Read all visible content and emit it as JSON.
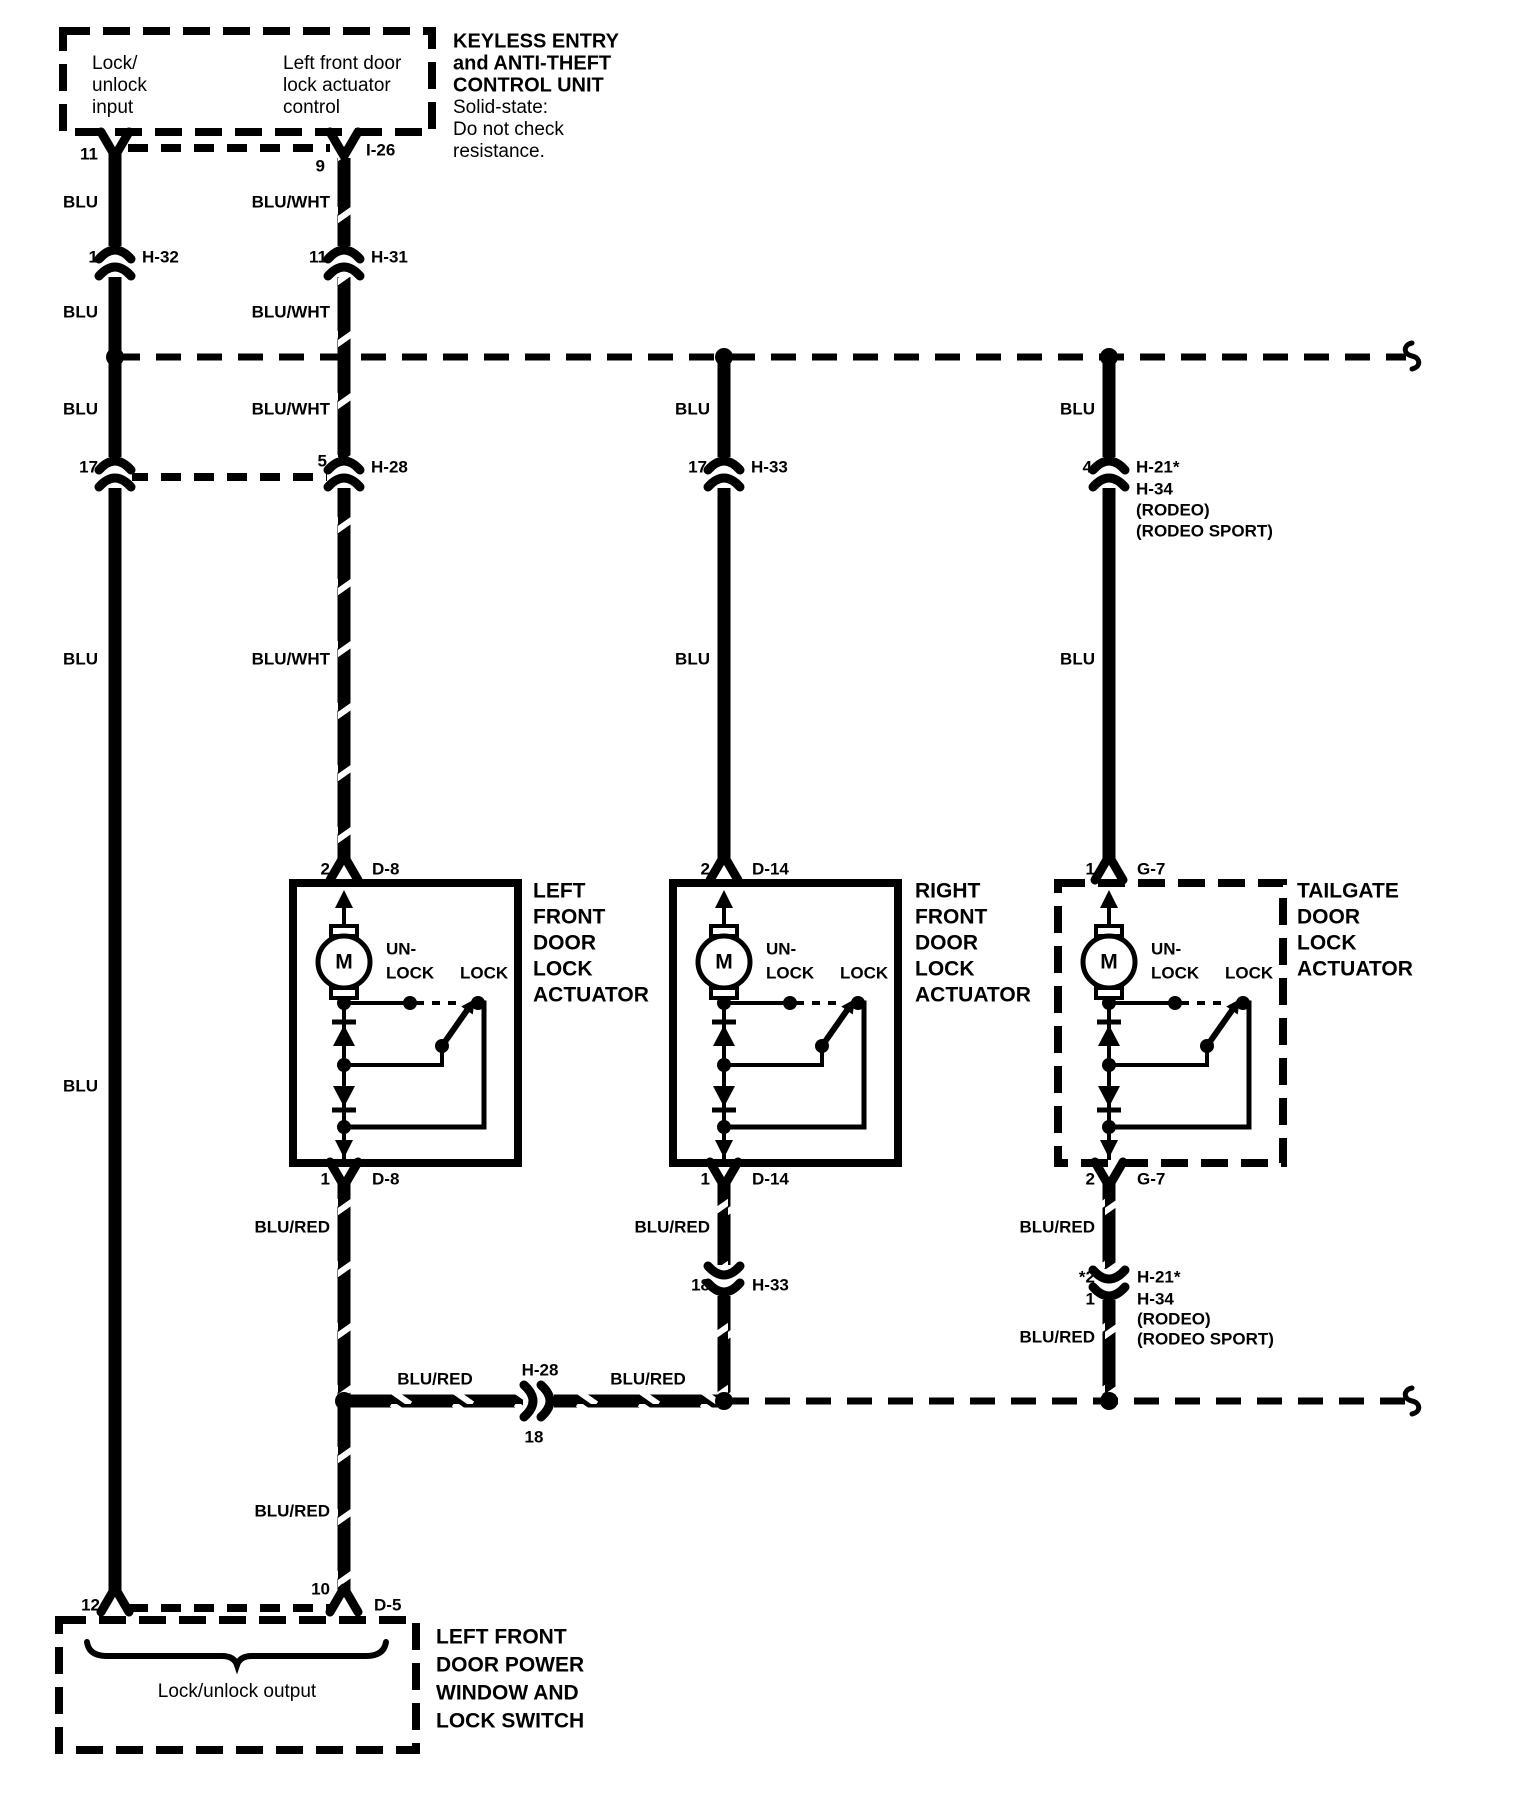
{
  "control_unit": {
    "title_lines": [
      "KEYLESS ENTRY",
      "and ANTI-THEFT",
      "CONTROL UNIT"
    ],
    "note_lines": [
      "Solid-state:",
      "Do not check",
      "resistance."
    ],
    "input_lines": [
      "Lock/",
      "unlock",
      "input"
    ],
    "output_lines": [
      "Left front door",
      "lock actuator",
      "control"
    ]
  },
  "switch_unit": {
    "title_lines": [
      "LEFT FRONT",
      "DOOR POWER",
      "WINDOW AND",
      "LOCK SWITCH"
    ],
    "brace_label": "Lock/unlock output"
  },
  "colors": {
    "blu": "BLU",
    "blu_wht": "BLU/WHT",
    "blu_red": "BLU/RED"
  },
  "connectors": {
    "i26": "I-26",
    "i26_pin_left": "11",
    "i26_pin_right": "9",
    "h32": "H-32",
    "h32_pin": "1",
    "h31": "H-31",
    "h31_pin": "11",
    "col1_pin17": "17",
    "h28": "H-28",
    "h28_pin": "5",
    "h33": "H-33",
    "h33_pin": "17",
    "h21": "H-21*",
    "h21_pin": "4",
    "h34": "H-34",
    "rodeo": "(RODEO)",
    "rodeo_sport": "(RODEO SPORT)",
    "h33_lower_pin": "18",
    "h21_lower_pin_a": "*2",
    "h21_lower_pin_b": "1",
    "h28_inline": "H-28",
    "h28_inline_pin": "18",
    "d5": "D-5",
    "d5_pin_left": "12",
    "d5_pin_right": "10"
  },
  "actuators": [
    {
      "pin_top": "2",
      "conn_top": "D-8",
      "pin_bottom": "1",
      "conn_bottom": "D-8",
      "motor": "M",
      "unlock_line1": "UN-",
      "unlock_line2": "LOCK",
      "lock": "LOCK",
      "name_lines": [
        "LEFT",
        "FRONT",
        "DOOR",
        "LOCK",
        "ACTUATOR"
      ]
    },
    {
      "pin_top": "2",
      "conn_top": "D-14",
      "pin_bottom": "1",
      "conn_bottom": "D-14",
      "motor": "M",
      "unlock_line1": "UN-",
      "unlock_line2": "LOCK",
      "lock": "LOCK",
      "name_lines": [
        "RIGHT",
        "FRONT",
        "DOOR",
        "LOCK",
        "ACTUATOR"
      ]
    },
    {
      "pin_top": "1",
      "conn_top": "G-7",
      "pin_bottom": "2",
      "conn_bottom": "G-7",
      "motor": "M",
      "unlock_line1": "UN-",
      "unlock_line2": "LOCK",
      "lock": "LOCK",
      "name_lines": [
        "TAILGATE",
        "DOOR",
        "LOCK",
        "ACTUATOR"
      ]
    }
  ]
}
